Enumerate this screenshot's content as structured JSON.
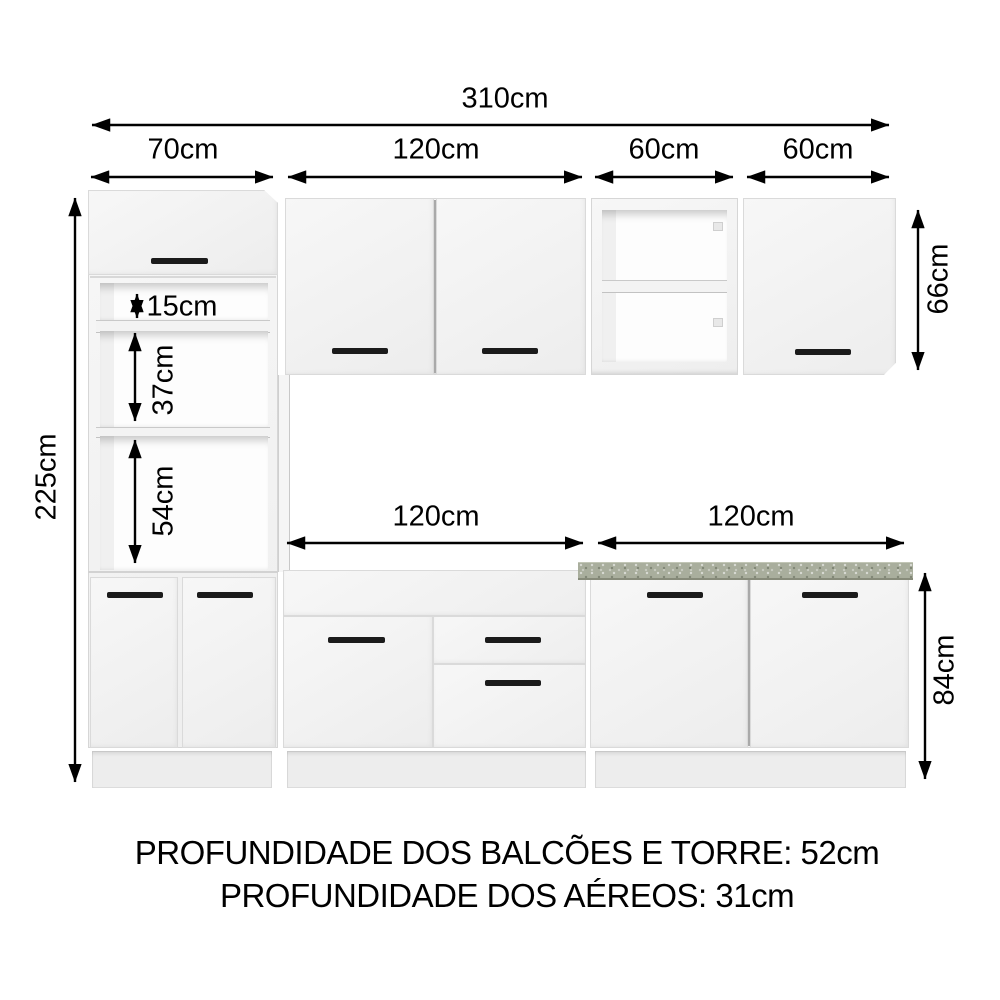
{
  "diagram": {
    "total_width_label": "310cm",
    "top_dims": {
      "tower": "70cm",
      "wall_double": "120cm",
      "wall_open": "60cm",
      "wall_single": "60cm"
    },
    "left_dim": "225cm",
    "right_dims": {
      "upper_cabinets_height": "66cm",
      "base_cabinets_height": "84cm"
    },
    "tower_openings": {
      "small": "15cm",
      "middle": "37cm",
      "large": "54cm"
    },
    "mid_dims": {
      "left_base_width": "120cm",
      "right_base_width": "120cm"
    },
    "footer": {
      "line1": "PROFUNDIDADE DOS BALCÕES E TORRE: 52cm",
      "line2": "PROFUNDIDADE DOS AÉREOS: 31cm"
    },
    "colors": {
      "dimension_lines": "#000000",
      "handles": "#1b1b1b",
      "countertop": "#a9ae9d",
      "cabinet_face": "#f3f3f3",
      "background": "#ffffff"
    }
  }
}
